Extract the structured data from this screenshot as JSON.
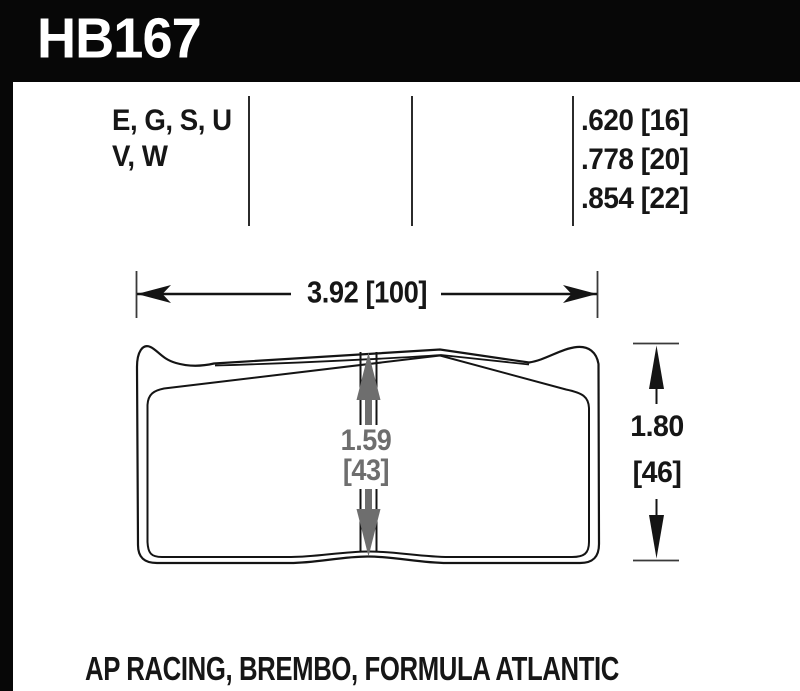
{
  "part_number": "HB167",
  "spec_table": {
    "compounds_line1": "E, G, S, U",
    "compounds_line2": "V, W",
    "thicknesses": [
      ".620 [16]",
      ".778 [20]",
      ".854 [22]"
    ]
  },
  "dimensions": {
    "width_label": "3.92 [100]",
    "center_thickness_in": "1.59",
    "center_thickness_mm": "[43]",
    "height_in": "1.80",
    "height_mm": "[46]"
  },
  "applications": "AP RACING, BREMBO, FORMULA ATLANTIC",
  "colors": {
    "header_bg": "#070707",
    "ink": "#161616",
    "gray_dimension": "#6e6e6e"
  }
}
